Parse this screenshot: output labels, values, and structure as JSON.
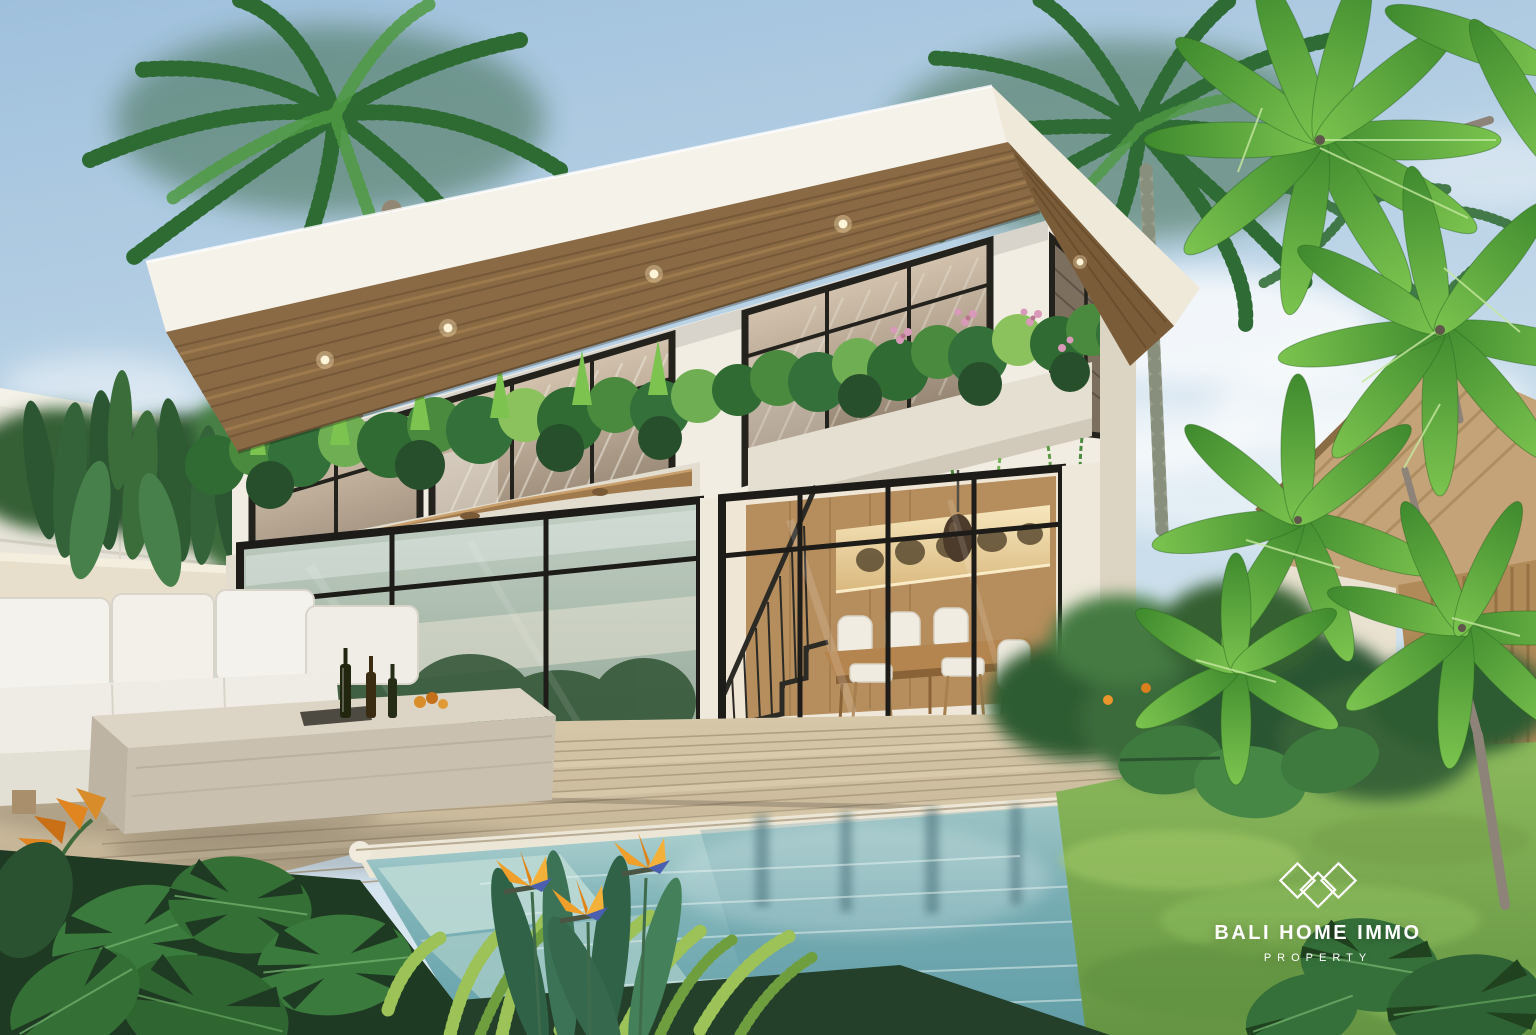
{
  "watermark": {
    "brand": "BALI HOME IMMO",
    "tagline": "PROPERTY",
    "logo_icon": "three-diamonds-icon",
    "text_color": "#ffffff"
  },
  "palette": {
    "sky_top": "#9fc0dc",
    "sky_horizon": "#dce9f1",
    "roof_fascia": "#f5f2ea",
    "roof_soffit_wood": "#8a6a44",
    "wall_white": "#f1ede3",
    "window_frame": "#21201c",
    "upper_glass": "#c2b09b",
    "lower_glass_reflection": "#a9bcae",
    "interior_wood": "#b68d5c",
    "deck_wood": "#cdbc9e",
    "pool_water": "#7db2b8",
    "pool_coping": "#ece6d6",
    "sofa_fabric": "#f4f2ec",
    "stone_table": "#d6cec0",
    "grass": "#7fae52",
    "foliage_dark": "#2e5b33",
    "foliage_bright": "#77c24f",
    "flower_orange": "#e8952b",
    "flower_pink": "#d89ab8",
    "thatch_roof": "#c3a377"
  }
}
